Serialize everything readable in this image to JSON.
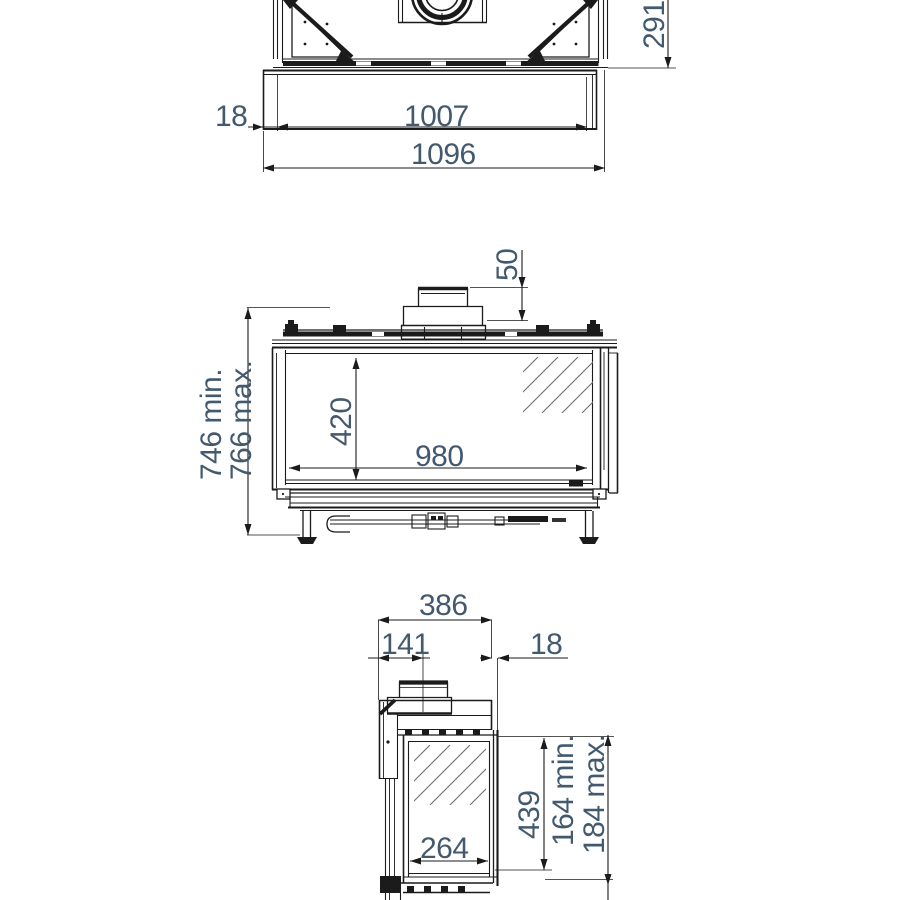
{
  "views": {
    "top": {
      "label": "top-view",
      "dims": {
        "offset_left": "18",
        "width_inner": "1007",
        "width_total": "1096",
        "depth": "291"
      }
    },
    "front": {
      "label": "front-view",
      "dims": {
        "collar_height": "50",
        "height_min": "746 min.",
        "height_max": "766 max.",
        "glass_height": "420",
        "glass_width": "980"
      }
    },
    "side": {
      "label": "side-view",
      "dims": {
        "depth_total": "386",
        "flue_center_from_back": "141",
        "front_offset": "18",
        "glass_height": "439",
        "plinth_min": "164 min.",
        "plinth_max": "184 max.",
        "glass_width": "264"
      }
    }
  },
  "colors": {
    "line": "#1b1b1b",
    "dim_text": "#43596e"
  }
}
